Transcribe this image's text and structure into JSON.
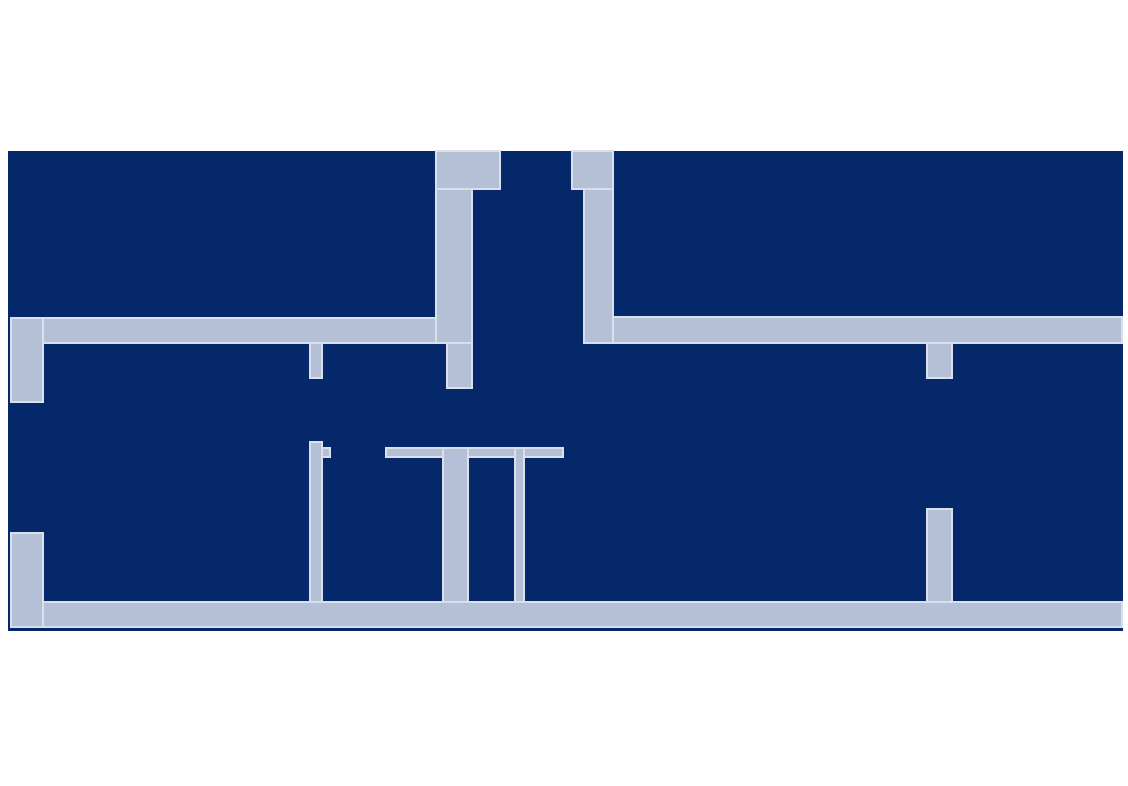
{
  "canvas": {
    "width": 1128,
    "height": 786,
    "background_color": "#ffffff"
  },
  "floor_plan": {
    "description": "building floor plan, dark structure with light corridors",
    "structure_color": "#04286a",
    "corridor_color": "#b3c0d6",
    "corridor_edge_color": "#d9e0ec",
    "outline": {
      "x": 8,
      "y": 151,
      "width": 1115,
      "height": 480
    },
    "shapes": [
      {
        "name": "upper-corridor-left",
        "x": 11,
        "y": 318,
        "width": 461,
        "height": 25
      },
      {
        "name": "upper-corridor-right",
        "x": 584,
        "y": 317,
        "width": 538,
        "height": 26
      },
      {
        "name": "bottom-corridor",
        "x": 11,
        "y": 602,
        "width": 1111,
        "height": 25
      },
      {
        "name": "left-wall-upper",
        "x": 11,
        "y": 318,
        "width": 32,
        "height": 84
      },
      {
        "name": "left-wall-lower",
        "x": 11,
        "y": 533,
        "width": 32,
        "height": 94
      },
      {
        "name": "pillar-left-cap",
        "x": 436,
        "y": 151,
        "width": 64,
        "height": 38
      },
      {
        "name": "pillar-left-shaft",
        "x": 436,
        "y": 189,
        "width": 36,
        "height": 154
      },
      {
        "name": "pillar-left-extension",
        "x": 447,
        "y": 343,
        "width": 25,
        "height": 45
      },
      {
        "name": "pillar-right-cap",
        "x": 572,
        "y": 151,
        "width": 41,
        "height": 38
      },
      {
        "name": "pillar-right-shaft",
        "x": 584,
        "y": 189,
        "width": 29,
        "height": 154
      },
      {
        "name": "mid-wall-stub-upper",
        "x": 310,
        "y": 343,
        "width": 12,
        "height": 35
      },
      {
        "name": "mid-wall-lower",
        "x": 310,
        "y": 442,
        "width": 12,
        "height": 160
      },
      {
        "name": "mid-wall-tick",
        "x": 322,
        "y": 448,
        "width": 8,
        "height": 9
      },
      {
        "name": "divider-band",
        "x": 386,
        "y": 448,
        "width": 177,
        "height": 9
      },
      {
        "name": "divider-strip-wide",
        "x": 443,
        "y": 448,
        "width": 25,
        "height": 154
      },
      {
        "name": "divider-strip-thin",
        "x": 515,
        "y": 448,
        "width": 9,
        "height": 154
      },
      {
        "name": "right-wall-stub-upper",
        "x": 927,
        "y": 343,
        "width": 25,
        "height": 35
      },
      {
        "name": "right-wall-lower",
        "x": 927,
        "y": 509,
        "width": 25,
        "height": 93
      }
    ]
  }
}
